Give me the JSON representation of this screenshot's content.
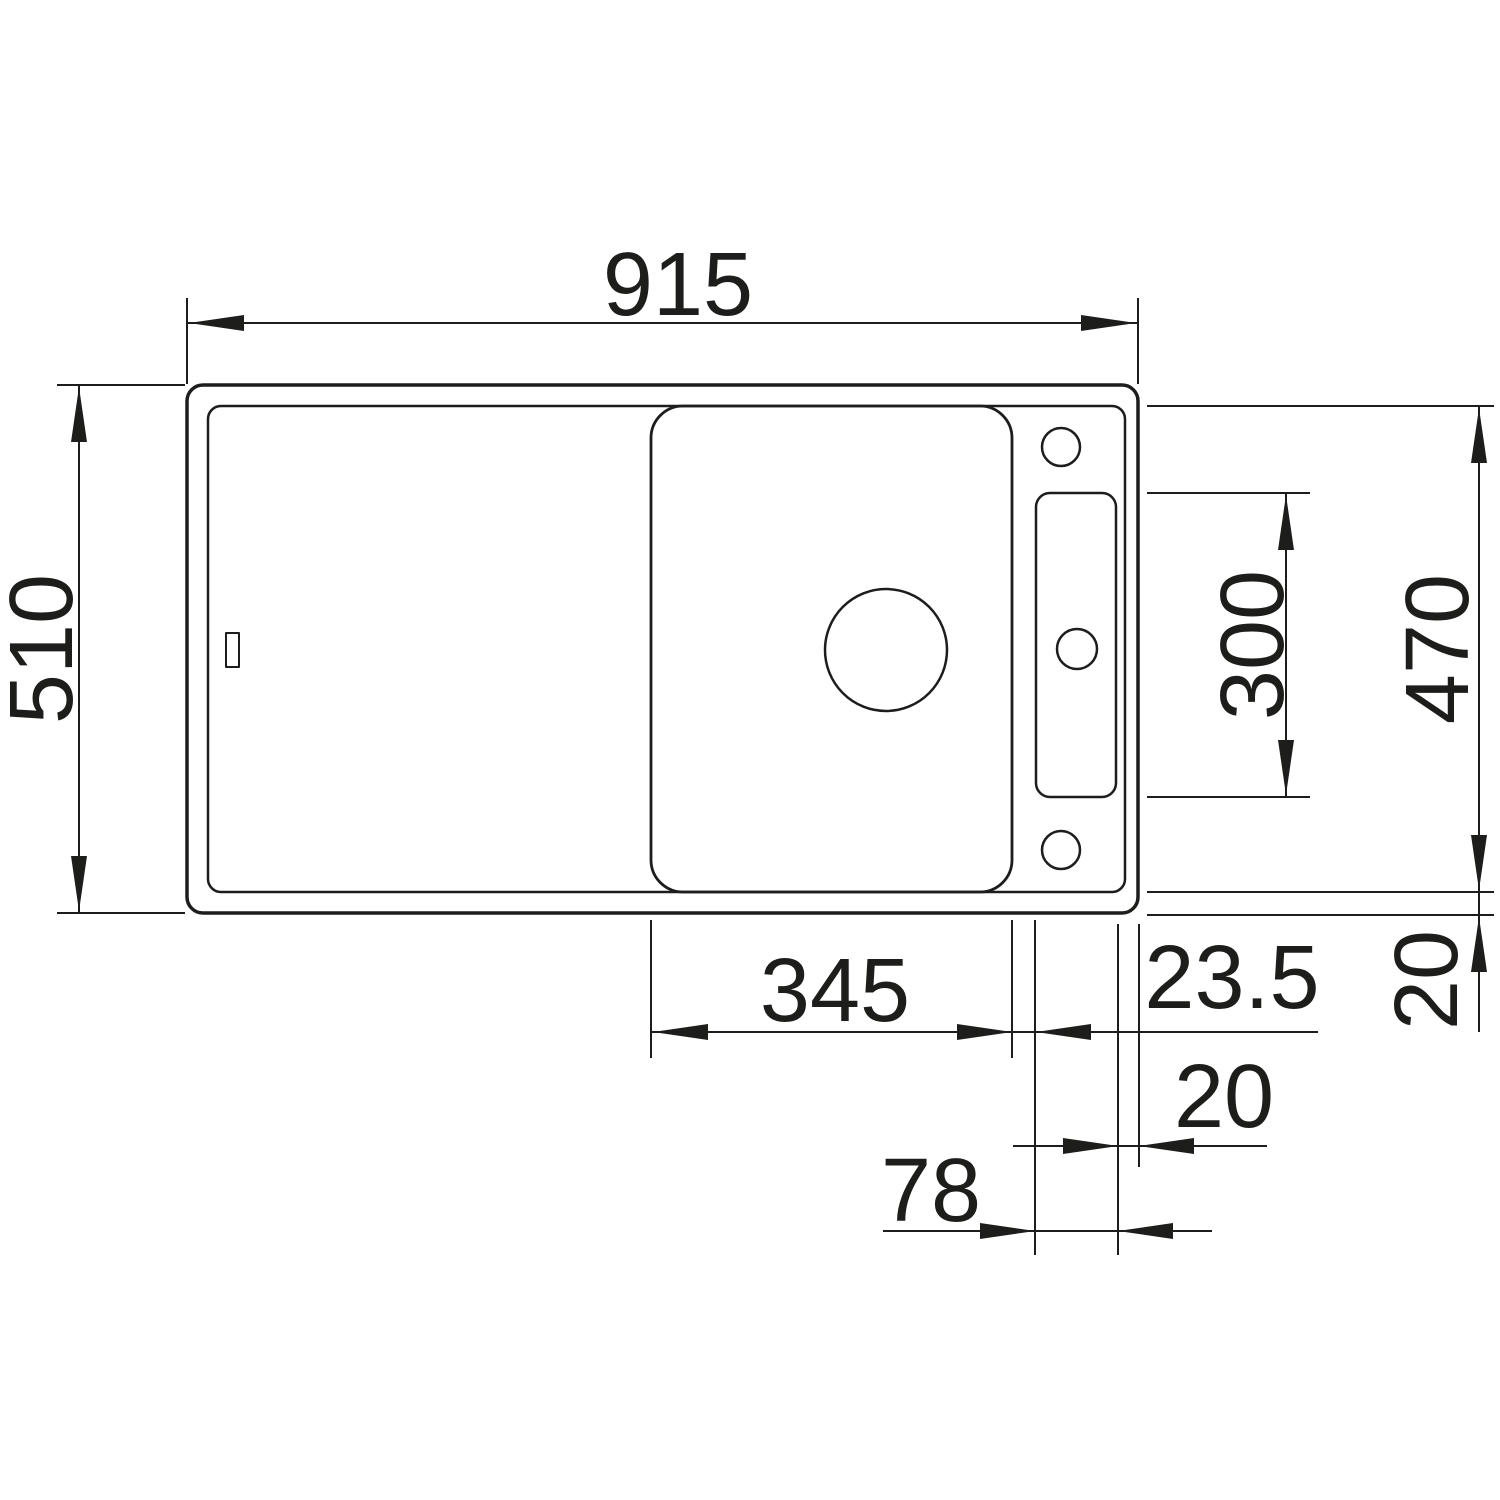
{
  "drawing": {
    "kind": "technical-dimension-drawing",
    "subject": "kitchen sink top view with drainboard, main bowl and accessory rail",
    "colors": {
      "line": "#1d1d1b",
      "background": "#ffffff"
    },
    "dims": {
      "overall_width": "915",
      "overall_depth": "510",
      "inner_depth": "470",
      "rail_length": "300",
      "bowl_width": "345",
      "bowl_rail_gap": "23.5",
      "right_rim": "20",
      "bottom_rim": "20",
      "rail_width": "78"
    }
  }
}
